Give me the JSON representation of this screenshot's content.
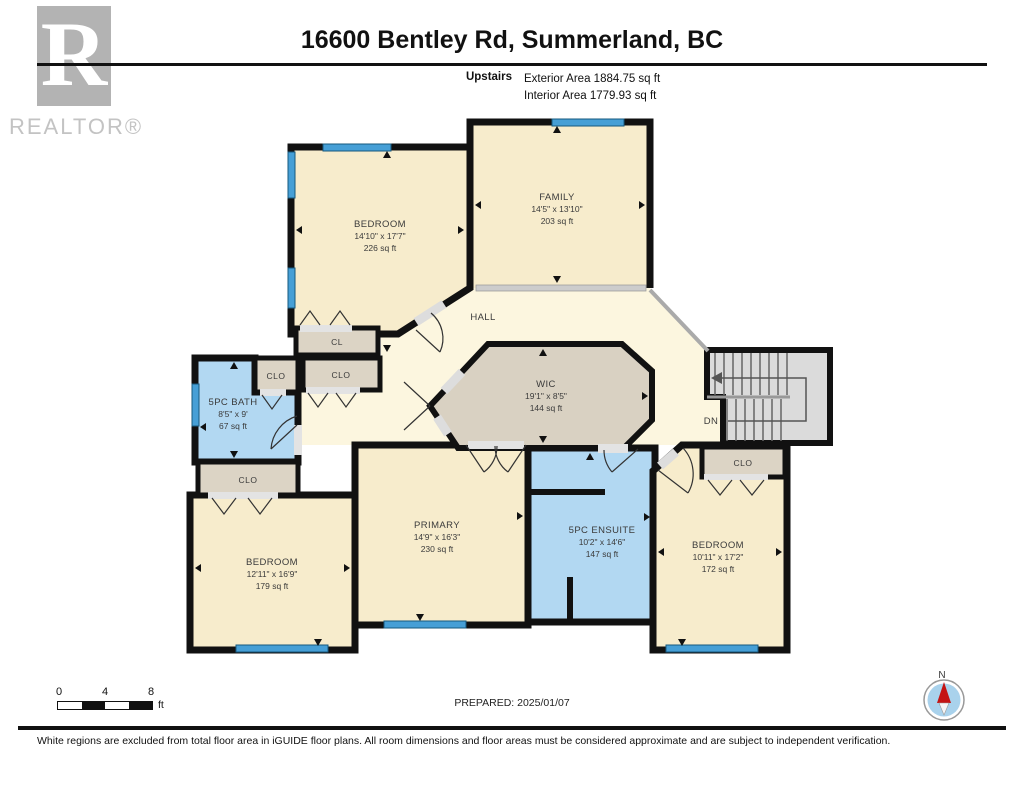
{
  "header": {
    "title": "16600 Bentley Rd, Summerland, BC",
    "floor_label": "Upstairs",
    "exterior_area": "Exterior Area 1884.75 sq ft",
    "interior_area": "Interior Area 1779.93 sq ft",
    "logo_letter": "R",
    "logo_word": "REALTOR®"
  },
  "plan": {
    "rooms": {
      "bedroom_top_left": {
        "name": "BEDROOM",
        "dims": "14'10\" x 17'7\"",
        "area": "226 sq ft"
      },
      "family": {
        "name": "FAMILY",
        "dims": "14'5\" x 13'10\"",
        "area": "203 sq ft"
      },
      "hall": {
        "name": "HALL"
      },
      "wic": {
        "name": "WIC",
        "dims": "19'1\" x 8'5\"",
        "area": "144 sq ft"
      },
      "bath": {
        "name": "5PC BATH",
        "dims": "8'5\" x 9'",
        "area": "67 sq ft"
      },
      "bedroom_bottom_left": {
        "name": "BEDROOM",
        "dims": "12'11\" x 16'9\"",
        "area": "179 sq ft"
      },
      "primary": {
        "name": "PRIMARY",
        "dims": "14'9\" x 16'3\"",
        "area": "230 sq ft"
      },
      "ensuite": {
        "name": "5PC ENSUITE",
        "dims": "10'2\" x 14'6\"",
        "area": "147 sq ft"
      },
      "bedroom_bottom_right": {
        "name": "BEDROOM",
        "dims": "10'11\" x 17'2\"",
        "area": "172 sq ft"
      }
    },
    "labels": {
      "closet": "CLO",
      "closet_small": "CL",
      "stairs_down": "DN"
    }
  },
  "scale_bar": {
    "tick0": "0",
    "tick1": "4",
    "tick2": "8",
    "unit": "ft"
  },
  "prepared_label": "PREPARED: 2025/01/07",
  "compass": {
    "north_label": "N"
  },
  "footer_note": "White regions are excluded from total floor area in iGUIDE floor plans. All room dimensions and floor areas must be considered approximate and are subject to independent verification.",
  "colors": {
    "wall": "#111111",
    "room_fill": "#f7eccc",
    "hall_fill": "#fcf6df",
    "closet_fill": "#dcd4c5",
    "wet_room_fill": "#b2d8f2",
    "window": "#469fd6",
    "stairs_fill": "#dbdbdb",
    "logo_gray": "#b3b3b3"
  }
}
